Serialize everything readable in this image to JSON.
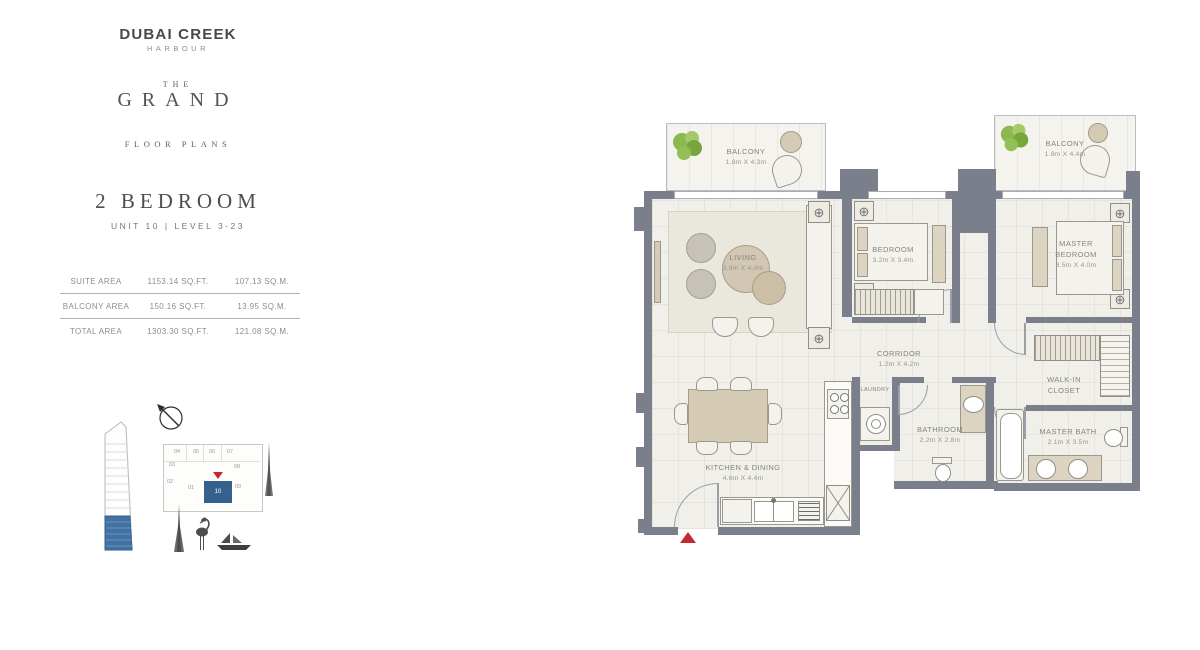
{
  "brand": {
    "name": "DUBAI CREEK",
    "sub": "HARBOUR",
    "the": "THE",
    "grand": "GRAND",
    "tagline": "FLOOR PLANS"
  },
  "unit": {
    "title": "2 BEDROOM",
    "subtitle": "UNIT 10 | LEVEL 3-23"
  },
  "areas": {
    "rows": [
      {
        "label": "SUITE AREA",
        "sqft": "1153.14 SQ.FT.",
        "sqm": "107.13 SQ.M."
      },
      {
        "label": "BALCONY AREA",
        "sqft": "150.16 SQ.FT.",
        "sqm": "13.95 SQ.M."
      },
      {
        "label": "TOTAL AREA",
        "sqft": "1303.30 SQ.FT.",
        "sqm": "121.08 SQ.M."
      }
    ]
  },
  "keyplan": {
    "units": [
      "04",
      "05",
      "06",
      "07",
      "03",
      "08",
      "02",
      "01",
      "10",
      "09"
    ],
    "highlighted_unit": "10",
    "highlight_color": "#36618f",
    "marker_color": "#c32b30"
  },
  "floorplan": {
    "rooms": {
      "balcony_left": {
        "name": "BALCONY",
        "dims": "1.8m X 4.3m"
      },
      "balcony_right": {
        "name": "BALCONY",
        "dims": "1.8m X 4.4m"
      },
      "living": {
        "name": "LIVING",
        "dims": "3.9m X 4.4m"
      },
      "bedroom": {
        "name": "BEDROOM",
        "dims": "3.2m X 3.4m"
      },
      "master_bedroom": {
        "name": "MASTER BEDROOM",
        "dims": "3.5m X 4.0m"
      },
      "corridor": {
        "name": "CORRIDOR",
        "dims": "1.2m X 4.2m"
      },
      "walk_in_closet": {
        "name": "WALK-IN CLOSET"
      },
      "laundry": {
        "name": "LAUNDRY"
      },
      "bathroom": {
        "name": "BATHROOM",
        "dims": "2.2m X 2.8m"
      },
      "master_bath": {
        "name": "MASTER BATH",
        "dims": "2.1m X 3.5m"
      },
      "kitchen": {
        "name": "KITCHEN & DINING",
        "dims": "4.6m X 4.4m"
      }
    },
    "colors": {
      "wall": "#7b7f8b",
      "floor": "#f0efea",
      "furniture": "#d5cab4",
      "plant": "#8db84e"
    }
  }
}
